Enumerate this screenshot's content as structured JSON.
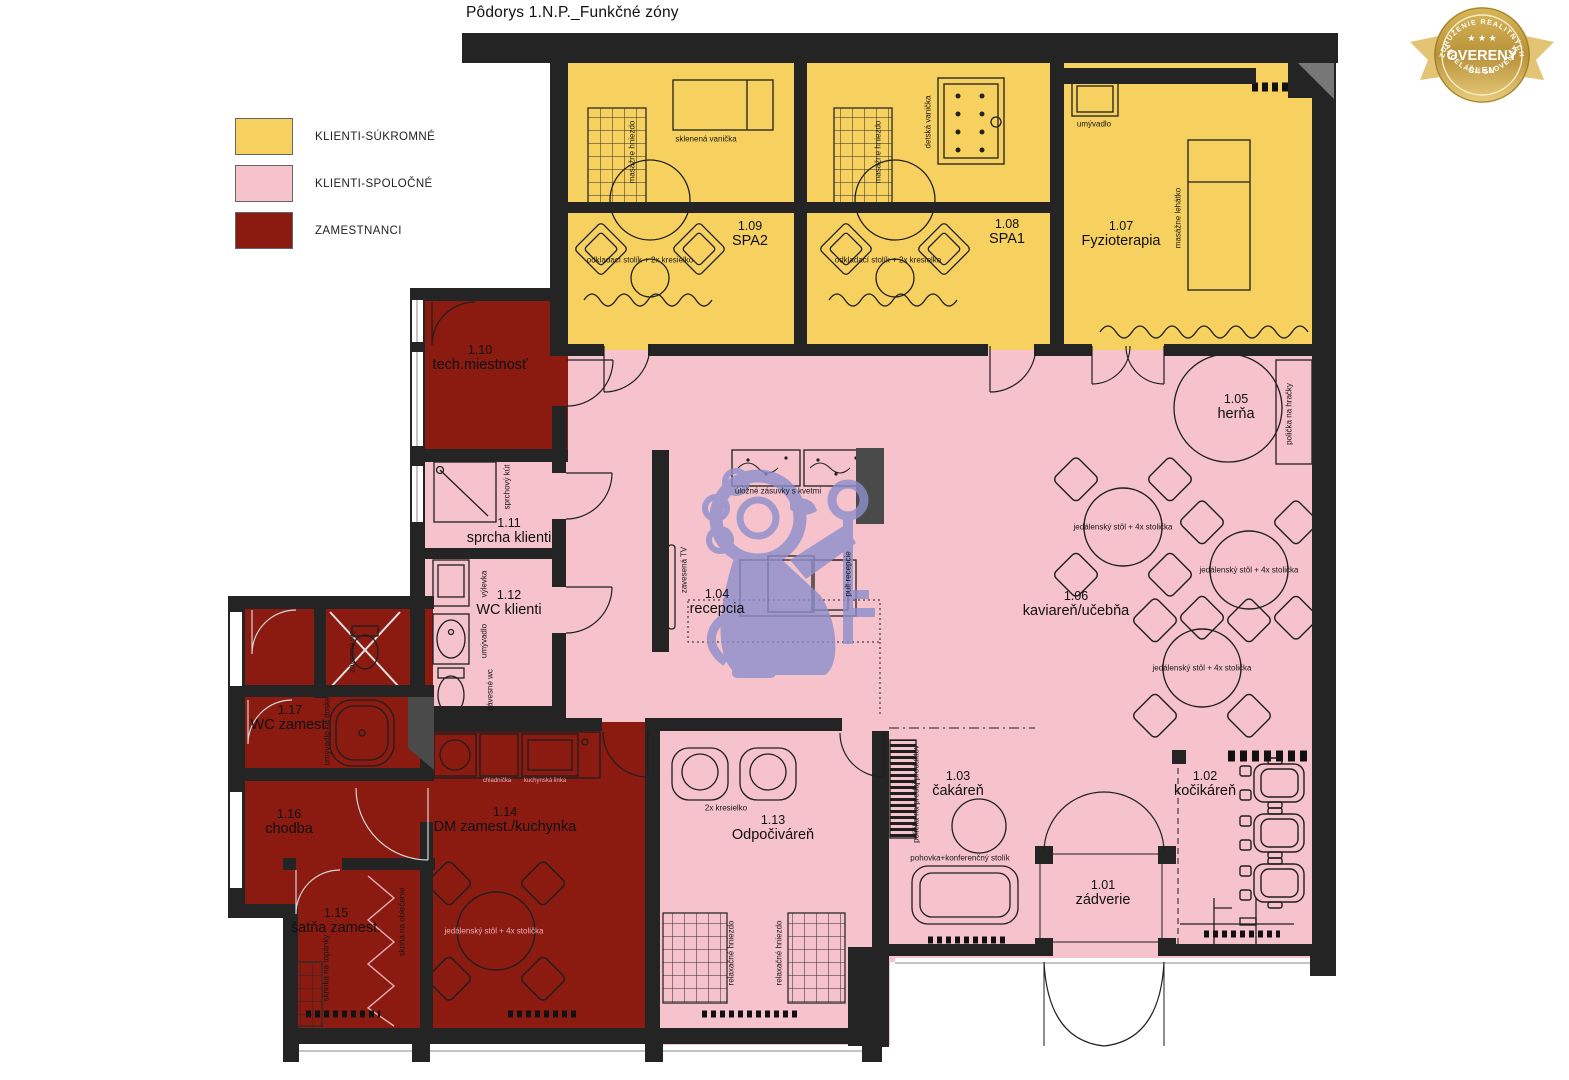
{
  "title": "Pôdorys 1.N.P._Funkčné zóny",
  "legend": {
    "items": [
      {
        "label": "KLIENTI-SÚKROMNÉ",
        "color": "#F7D160"
      },
      {
        "label": "KLIENTI-SPOLOČNÉ",
        "color": "#F6C2CB"
      },
      {
        "label": "ZAMESTNANCI",
        "color": "#8B1A10"
      }
    ]
  },
  "badge": {
    "top_text": "ZDRUŽENIE REALITNÝCH",
    "bottom_text": "KANCELÁRIÍ SLOVENSKA",
    "stars": "★ ★ ★",
    "main_text": "OVERENÝ",
    "sub_text": "ČLEN"
  },
  "zone_colors": {
    "klienti_sukromne": "#F7D160",
    "klienti_spolocne": "#F6C2CB",
    "zamestnanci": "#8B1A10"
  },
  "rooms": [
    {
      "number": "1.01",
      "name": "zádverie",
      "zone": "klienti-spolocne",
      "x": 1103,
      "y": 893
    },
    {
      "number": "1.02",
      "name": "kočikáreň",
      "zone": "klienti-spolocne",
      "x": 1205,
      "y": 784
    },
    {
      "number": "1.03",
      "name": "čakáreň",
      "zone": "klienti-spolocne",
      "x": 958,
      "y": 784
    },
    {
      "number": "1.04",
      "name": "recepcia",
      "zone": "klienti-spolocne",
      "x": 717,
      "y": 602
    },
    {
      "number": "1.05",
      "name": "herňa",
      "zone": "klienti-spolocne",
      "x": 1236,
      "y": 407
    },
    {
      "number": "1.06",
      "name": "kaviareň/učebňa",
      "zone": "klienti-spolocne",
      "x": 1076,
      "y": 604
    },
    {
      "number": "1.07",
      "name": "Fyzioterapia",
      "zone": "klienti-sukromne",
      "x": 1121,
      "y": 234
    },
    {
      "number": "1.08",
      "name": "SPA1",
      "zone": "klienti-sukromne",
      "x": 1007,
      "y": 232
    },
    {
      "number": "1.09",
      "name": "SPA2",
      "zone": "klienti-sukromne",
      "x": 750,
      "y": 234
    },
    {
      "number": "1.10",
      "name": "tech.miestnosť",
      "zone": "zamestnanci",
      "x": 480,
      "y": 358
    },
    {
      "number": "1.11",
      "name": "sprcha klienti",
      "zone": "klienti-spolocne",
      "x": 509,
      "y": 531
    },
    {
      "number": "1.12",
      "name": "WC klienti",
      "zone": "klienti-spolocne",
      "x": 509,
      "y": 603
    },
    {
      "number": "1.13",
      "name": "Odpočiváreň",
      "zone": "klienti-spolocne",
      "x": 773,
      "y": 828
    },
    {
      "number": "1.14",
      "name": "DM zamest./kuchynka",
      "zone": "zamestnanci",
      "x": 505,
      "y": 820
    },
    {
      "number": "1.15",
      "name": "šatňa zamest.",
      "zone": "zamestnanci",
      "x": 336,
      "y": 921
    },
    {
      "number": "1.16",
      "name": "chodba",
      "zone": "zamestnanci",
      "x": 289,
      "y": 822
    },
    {
      "number": "1.17",
      "name": "WC zamest.",
      "zone": "zamestnanci",
      "x": 290,
      "y": 718
    }
  ],
  "annotations": [
    {
      "text": "masážne hniezdo",
      "x": 632,
      "y": 152,
      "vertical": true
    },
    {
      "text": "sklenená vanička",
      "x": 706,
      "y": 139
    },
    {
      "text": "odkladací stolík + 2x kresielko",
      "x": 640,
      "y": 260
    },
    {
      "text": "masážne hniezdo",
      "x": 878,
      "y": 152,
      "vertical": true
    },
    {
      "text": "detská vanička",
      "x": 928,
      "y": 122,
      "vertical": true
    },
    {
      "text": "odkladací stolík + 2x kresielko",
      "x": 888,
      "y": 260
    },
    {
      "text": "umývadlo",
      "x": 1094,
      "y": 124
    },
    {
      "text": "masážne lehátko",
      "x": 1178,
      "y": 218,
      "vertical": true
    },
    {
      "text": "sprchový kút",
      "x": 507,
      "y": 487,
      "vertical": true
    },
    {
      "text": "výlevka",
      "x": 484,
      "y": 584,
      "vertical": true
    },
    {
      "text": "umývadlo",
      "x": 484,
      "y": 641,
      "vertical": true
    },
    {
      "text": "závesné wc",
      "x": 490,
      "y": 690,
      "vertical": true
    },
    {
      "text": "zavesená TV",
      "x": 684,
      "y": 570,
      "vertical": true
    },
    {
      "text": "úložné zásuvky s kvetmi",
      "x": 778,
      "y": 491
    },
    {
      "text": "pult recepcie",
      "x": 848,
      "y": 574,
      "vertical": true
    },
    {
      "text": "polička na hračky",
      "x": 1289,
      "y": 414,
      "vertical": true
    },
    {
      "text": "jedálenský stôl + 4x stolička",
      "x": 1123,
      "y": 527
    },
    {
      "text": "jedálenský stôl + 4x stolička",
      "x": 1249,
      "y": 570
    },
    {
      "text": "jedálenský stôl + 4x stolička",
      "x": 1202,
      "y": 668
    },
    {
      "text": "jedálenský stôl + 4x stolička",
      "x": 494,
      "y": 931,
      "light": true
    },
    {
      "text": "relaxačné hniezdo",
      "x": 731,
      "y": 953,
      "vertical": true
    },
    {
      "text": "relaxačné hniezdo",
      "x": 779,
      "y": 953,
      "vertical": true
    },
    {
      "text": "2x kresielko",
      "x": 726,
      "y": 808
    },
    {
      "text": "pohovka+konferenčný stolík",
      "x": 960,
      "y": 858
    },
    {
      "text": "polička na predaj produktov",
      "x": 916,
      "y": 794,
      "vertical": true
    },
    {
      "text": "umývadlo na doske",
      "x": 327,
      "y": 731,
      "vertical": true
    },
    {
      "text": "závesné wc",
      "x": 352,
      "y": 652,
      "vertical": true
    },
    {
      "text": "skriňa na oblečenie",
      "x": 402,
      "y": 922,
      "vertical": true
    },
    {
      "text": "skrinka na topánky",
      "x": 326,
      "y": 968,
      "vertical": true
    },
    {
      "text": "chladnička",
      "x": 497,
      "y": 781,
      "light": true,
      "tiny": true
    },
    {
      "text": "kuchynská linka",
      "x": 545,
      "y": 781,
      "light": true,
      "tiny": true
    }
  ]
}
